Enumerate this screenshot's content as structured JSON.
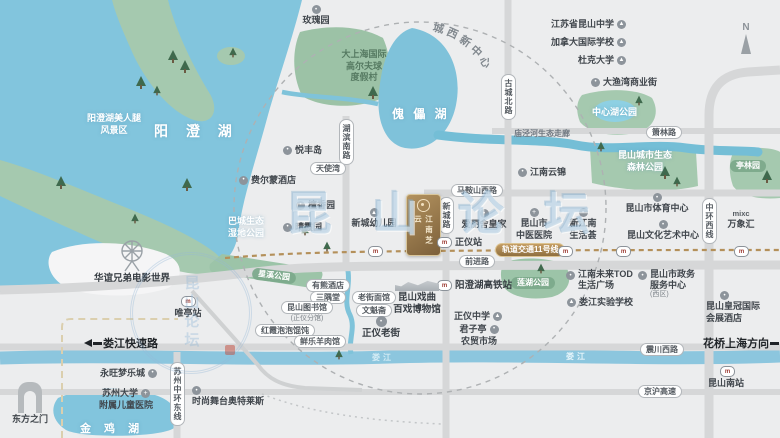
{
  "colors": {
    "water": "#82c5dd",
    "land": "#ecedee",
    "park_green": "#a5c9af",
    "road": "#d6d7d8",
    "metro_gold": "#b4905a",
    "project_gold": "#94744a",
    "black_label": "#1f2327",
    "white_pill": "#ffffff"
  },
  "compass": {
    "label": "N"
  },
  "watermark": {
    "text": "昆山论坛"
  },
  "project_card": {
    "name": "江南芝云"
  },
  "curved_label": {
    "c0": "城",
    "c1": "西",
    "c2": "新",
    "c3": "中",
    "c4": "心"
  },
  "lakes": {
    "yangchenghu": "阳 澄 湖",
    "kuileihu": "傀 儡 湖",
    "jinjihu": "金 鸡 湖",
    "loujiang": "娄江"
  },
  "areas": {
    "scenic_l1": "阳澄湖美人腿",
    "scenic_l2": "风景区",
    "wetland_l1": "巴城生态",
    "wetland_l2": "湿地公园",
    "golf_l1": "大上海国际",
    "golf_l2": "高尔夫球",
    "golf_l3": "度假村",
    "central_lake_park": "中心湖公园",
    "forest_l1": "昆山城市生态",
    "forest_l2": "森林公园",
    "tinglin": "亭林园",
    "xingxi": "星溪公园",
    "lianhu": "莲湖公园",
    "miaojing": "庙泾河生态走廊"
  },
  "roads": {
    "hubin_south": "湖滨南路",
    "gucheng_north": "古城北路",
    "xincheng": "新城路",
    "zhonghuan_west": "中环西线",
    "suzhou_zhonghuan_east": "苏州中环东线",
    "xiaolin": "箫林路",
    "maanshan_west": "马鞍山西路",
    "qianjin": "前进路",
    "zhenchuan_west": "震川西路",
    "jinghu": "京沪高速",
    "loujiang_expwy": "娄江快速路",
    "huaqiao": "花桥上海方向",
    "metro11": "轨道交通11号线"
  },
  "pois": {
    "rose_garden": "玫瑰园",
    "yuefeng_island": "悦丰岛",
    "angel_bay": "天使湾",
    "fairmont": "费尔蒙酒店",
    "tanxiang": "檀香园",
    "qingxia": "晴霞园",
    "kindergarten": "新城幼儿园",
    "elysee": "爱丽舍皇家",
    "jiangnan_yunjin": "江南云锦",
    "sports_center": "昆山市体育中心",
    "art_center": "昆山文化艺术中心",
    "mixc": "万象汇",
    "mixc_logo": "mixc",
    "tcm_l1": "昆山市",
    "tcm_l2": "中医医院",
    "xinjiangnan_l1": "新江南",
    "xinjiangnan_l2": "生活荟",
    "zhengyi_station": "正仪站",
    "hsr_station": "阳澄湖高铁站",
    "zhengyi_school": "正仪中学",
    "junziting_l1": "君子亭",
    "junziting_l2": "农贸市场",
    "tod_l1": "江南未来TOD",
    "tod_l2": "生活广场",
    "loujiang_school": "娄江实验学校",
    "gov_l1": "昆山市政务",
    "gov_l2": "服务中心",
    "gov_l3": "(西区)",
    "crowne_l1": "昆山皇冠国际",
    "crowne_l2": "会展酒店",
    "kunshan_south": "昆山南站",
    "weiting": "唯亭站",
    "aeon": "永旺梦乐城",
    "suda_l1": "苏州大学",
    "suda_l2": "附属儿童医院",
    "outlets": "时尚舞台奥特莱斯",
    "oriental_gate": "东方之门",
    "huayi": "华谊兄弟电影世界",
    "library": "昆山图书馆",
    "library_sub": "(正仪分馆)",
    "youxiong": "有熊酒店",
    "sanyutang": "三隅堂",
    "hongxia": "红霞泡泡馄饨",
    "xianle": "鲜乐羊肉馆",
    "laojie_noodle": "老街面馆",
    "wenkuizhai": "文魁斋",
    "zhengyi_old_street": "正仪老街",
    "opera_l1": "昆山戏曲",
    "opera_l2": "百戏博物馆",
    "ks_highschool": "江苏省昆山中学",
    "canada_school": "加拿大国际学校",
    "duke": "杜克大学",
    "dayuwan": "大渔湾商业街"
  }
}
